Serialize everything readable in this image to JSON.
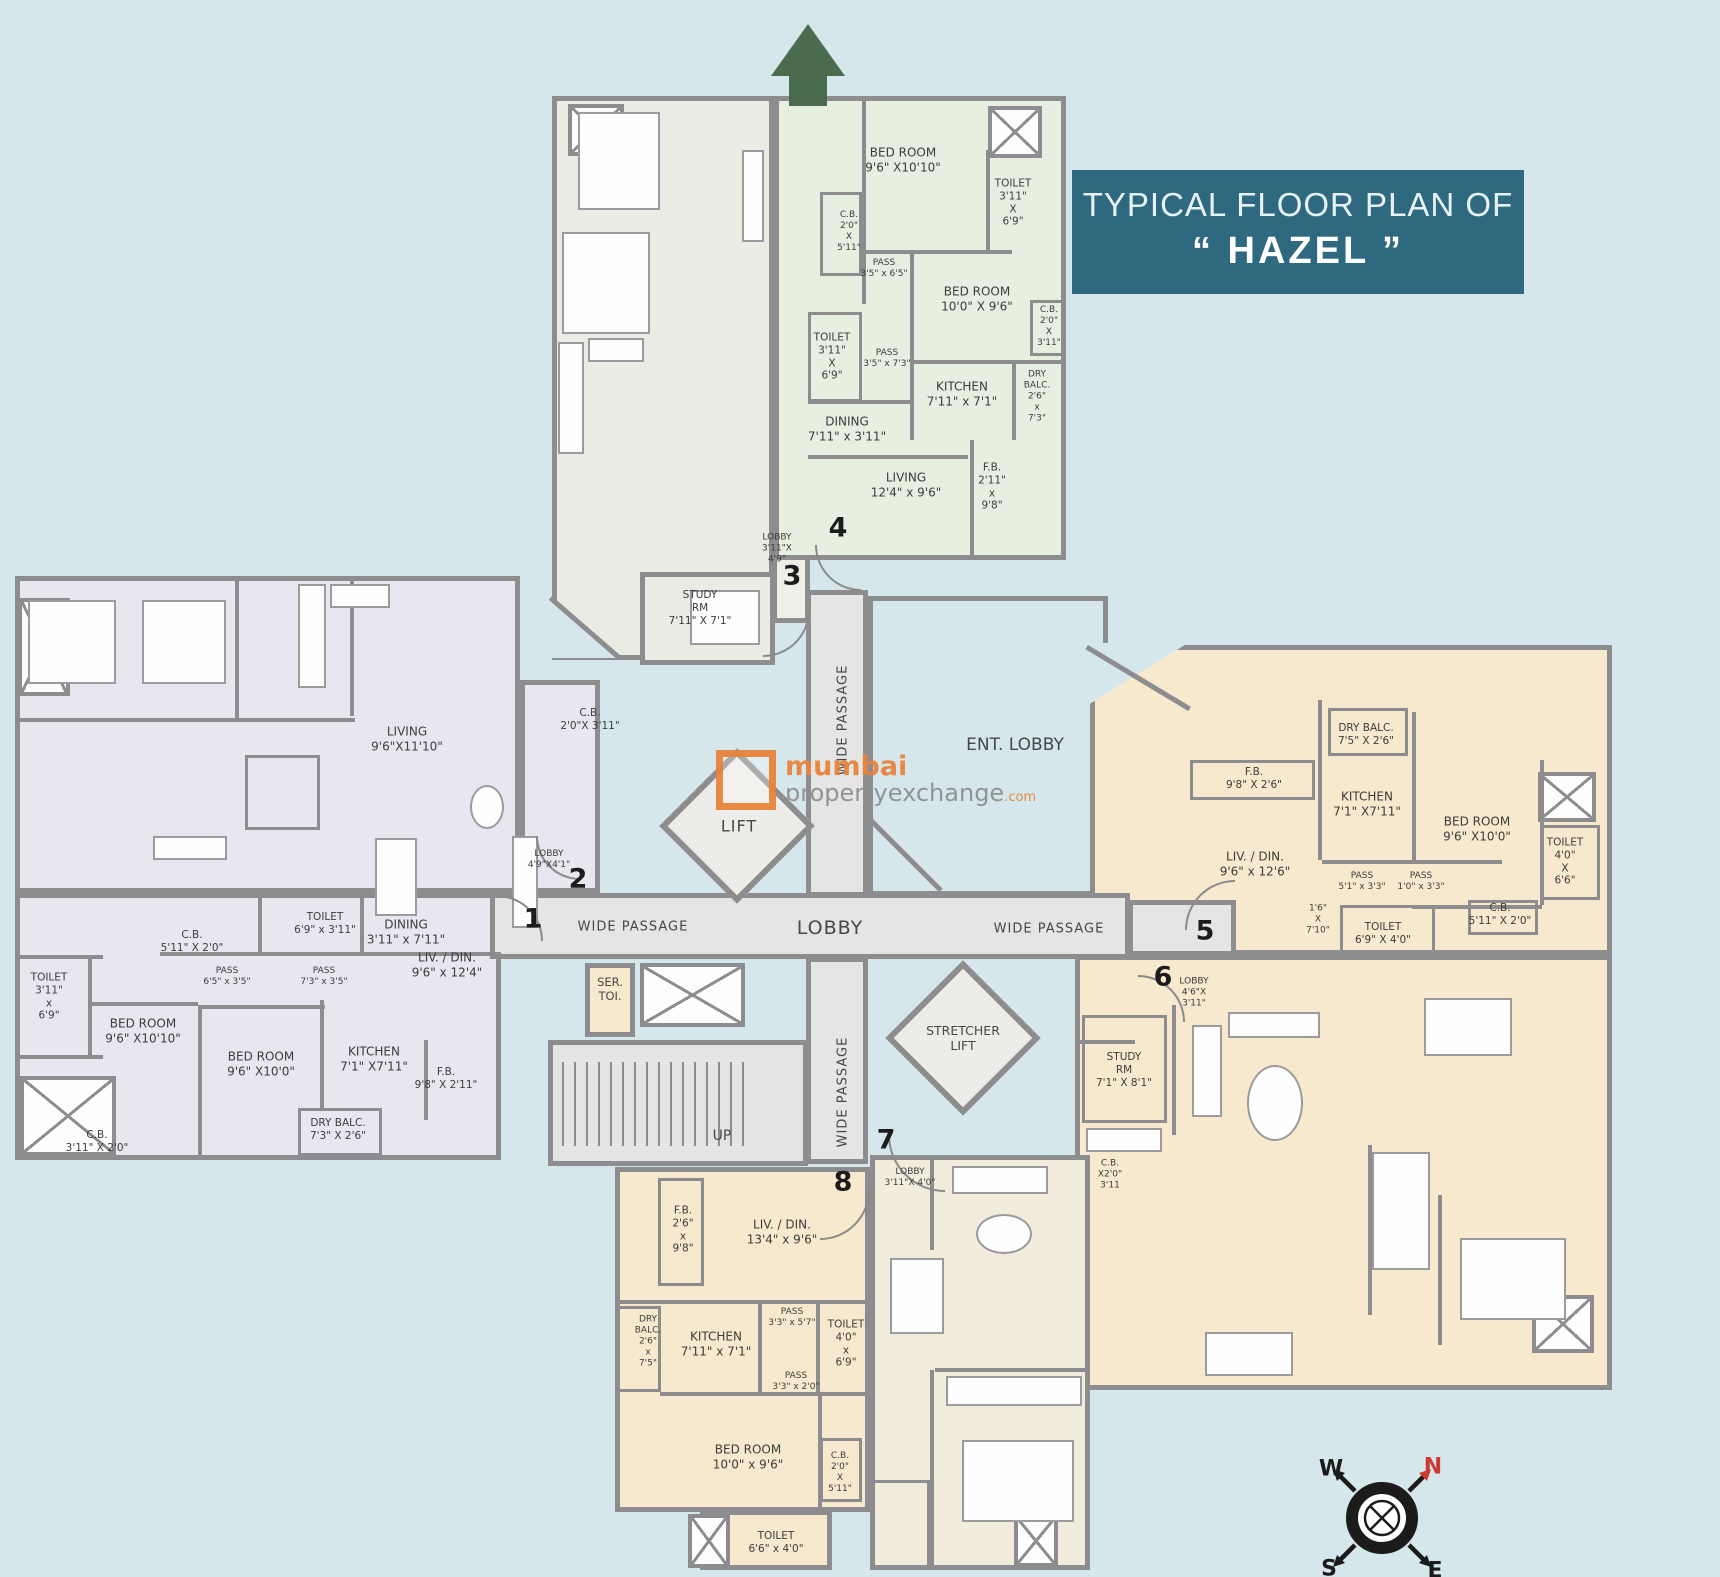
{
  "title": {
    "line1": "TYPICAL FLOOR PLAN OF",
    "line2": "“ HAZEL ”"
  },
  "watermark": {
    "brand": "mumbai",
    "brand2": "propertyexchange",
    "tld": ".com"
  },
  "compass": {
    "w": "W",
    "n": "N",
    "s": "S",
    "e": "E"
  },
  "colors": {
    "title_bg": "#2f697f",
    "north_arrow_green": "#4b6b4f",
    "compass_north_red": "#cf3832",
    "watermark_orange": "#e8843c",
    "wing_left": "#eae6f0",
    "wing_top_left": "#e9ece2",
    "wing_top_right": "#e7efe1",
    "wing_right": "#f7e9cd",
    "wing_bottom": "#f1ecdb",
    "background": "#d5e7eb",
    "wall_grey": "#8d8c8e"
  },
  "core": {
    "lift": "LIFT",
    "stretcher": "STRETCHER\nLIFT",
    "lobby": "LOBBY",
    "ent_lobby": "ENT. LOBBY",
    "wp_top": "WIDE PASSAGE",
    "wp_bottom": "WIDE PASSAGE",
    "wp_left": "WIDE PASSAGE",
    "wp_right": "WIDE PASSAGE",
    "up": "UP",
    "ser_toi": "SER.\nTOI."
  },
  "units": {
    "n1": "1",
    "n2": "2",
    "n3": "3",
    "n4": "4",
    "n5": "5",
    "n6": "6",
    "n7": "7",
    "n8": "8"
  },
  "rooms": [
    {
      "n": "BED ROOM",
      "d": "9'6\" X10'10\""
    },
    {
      "n": "TOILET",
      "d": "3'11\"\nX\n6'9\""
    },
    {
      "n": "C.B.",
      "d": "2'0\"\nX\n5'11\""
    },
    {
      "n": "PASS",
      "d": "3'5\" x 6'5\""
    },
    {
      "n": "BED ROOM",
      "d": "10'0\" X 9'6\""
    },
    {
      "n": "C.B.",
      "d": "2'0\"\nX\n3'11\""
    },
    {
      "n": "TOILET",
      "d": "3'11\"\nX\n6'9\""
    },
    {
      "n": "PASS",
      "d": "3'5\" x 7'3\""
    },
    {
      "n": "KITCHEN",
      "d": "7'11\" x 7'1\""
    },
    {
      "n": "DRY\nBALC.",
      "d": "2'6\"\nx\n7'3\""
    },
    {
      "n": "DINING",
      "d": "7'11\" x 3'11\""
    },
    {
      "n": "LIVING",
      "d": "12'4\" x 9'6\""
    },
    {
      "n": "F.B.",
      "d": "2'11\"\nx\n9'8\""
    },
    {
      "n": "LOBBY",
      "d": "3'11\"X\n4'9\""
    },
    {
      "n": "STUDY\nRM",
      "d": "7'11\" X 7'1\""
    },
    {
      "n": "C.B.",
      "d": "2'0\"X 3'11\""
    },
    {
      "n": "LIVING",
      "d": "9'6\"X11'10\""
    },
    {
      "n": "LOBBY",
      "d": "4'9\"X4'1\""
    },
    {
      "n": "C.B.",
      "d": "5'11\" X 2'0\""
    },
    {
      "n": "TOILET",
      "d": "6'9\" x 3'11\""
    },
    {
      "n": "DINING",
      "d": "3'11\" x 7'11\""
    },
    {
      "n": "PASS",
      "d": "6'5\" x 3'5\""
    },
    {
      "n": "PASS",
      "d": "7'3\" x 3'5\""
    },
    {
      "n": "LIV. / DIN.",
      "d": "9'6\" x 12'4\""
    },
    {
      "n": "TOILET",
      "d": "3'11\"\nx\n6'9\""
    },
    {
      "n": "BED ROOM",
      "d": "9'6\" X10'10\""
    },
    {
      "n": "BED ROOM",
      "d": "9'6\" X10'0\""
    },
    {
      "n": "KITCHEN",
      "d": "7'1\" X7'11\""
    },
    {
      "n": "F.B.",
      "d": "9'8\" X 2'11\""
    },
    {
      "n": "DRY BALC.",
      "d": "7'3\" X 2'6\""
    },
    {
      "n": "C.B.",
      "d": "3'11\" X 2'0\""
    },
    {
      "n": "DRY BALC.",
      "d": "7'5\" X 2'6\""
    },
    {
      "n": "F.B.",
      "d": "9'8\" X 2'6\""
    },
    {
      "n": "KITCHEN",
      "d": "7'1\" X7'11\""
    },
    {
      "n": "BED ROOM",
      "d": "9'6\" X10'0\""
    },
    {
      "n": "LIV. / DIN.",
      "d": "9'6\" x 12'6\""
    },
    {
      "n": "PASS",
      "d": "5'1\" x 3'3\""
    },
    {
      "n": "PASS",
      "d": "1'0\" x 3'3\""
    },
    {
      "n": "TOILET",
      "d": "4'0\"\nX\n6'6\""
    },
    {
      "n": "1'6\"",
      "d": "X\n7'10\""
    },
    {
      "n": "TOILET",
      "d": "6'9\" X 4'0\""
    },
    {
      "n": "C.B.",
      "d": "5'11\" X 2'0\""
    },
    {
      "n": "LOBBY",
      "d": "4'6\"X\n3'11\""
    },
    {
      "n": "STUDY\nRM",
      "d": "7'1\" X 8'1\""
    },
    {
      "n": "C.B.",
      "d": "X2'0\"\n3'11"
    },
    {
      "n": "F.B.",
      "d": "2'6\"\nx\n9'8\""
    },
    {
      "n": "LIV. / DIN.",
      "d": "13'4\" x 9'6\""
    },
    {
      "n": "DRY\nBALC.",
      "d": "2'6\"\nx\n7'5\""
    },
    {
      "n": "KITCHEN",
      "d": "7'11\" x 7'1\""
    },
    {
      "n": "PASS",
      "d": "3'3\" x 5'7\""
    },
    {
      "n": "TOILET",
      "d": "4'0\"\nx\n6'9\""
    },
    {
      "n": "PASS",
      "d": "3'3\" x 2'0\""
    },
    {
      "n": "BED ROOM",
      "d": "10'0\" x 9'6\""
    },
    {
      "n": "C.B.",
      "d": "2'0\"\nX\n5'11\""
    },
    {
      "n": "TOILET",
      "d": "6'6\" x 4'0\""
    },
    {
      "n": "LOBBY",
      "d": "3'11\"X 4'0\""
    }
  ]
}
